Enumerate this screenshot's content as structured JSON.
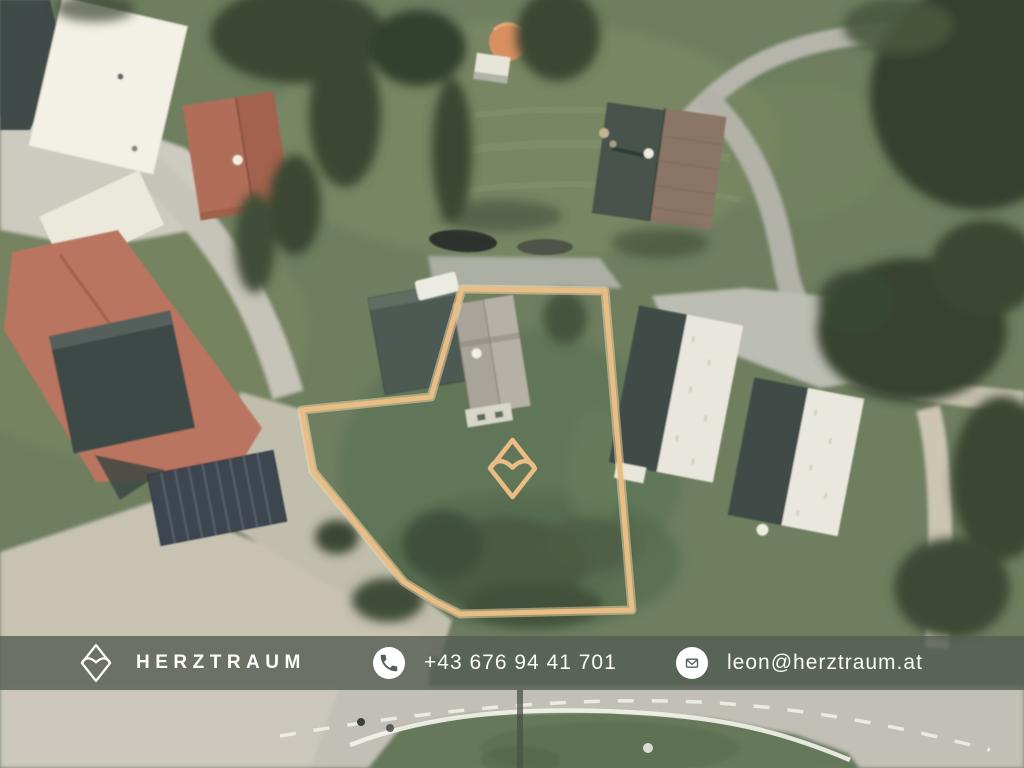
{
  "brand": {
    "name": "HERZTRAUM",
    "logo": "heart-in-diamond"
  },
  "contact": {
    "phone": {
      "label": "+43 676 94 41 701"
    },
    "email": {
      "label": "leon@herztraum.at"
    }
  },
  "map": {
    "type": "aerial-photo",
    "boundary_points": "462,289 605,291 632,610 460,614 436,602 404,582 341,505 322,482 313,471 302,410 431,397",
    "marker": "herztraum-heart-diamond-marker"
  },
  "colors": {
    "boundary": "#EABD85",
    "boundary_halo": "#F6DCAC",
    "footer_bar": "rgba(84,92,84,0.80)",
    "footer_text": "#FAFAF6",
    "icon_glyph": "#566058"
  }
}
